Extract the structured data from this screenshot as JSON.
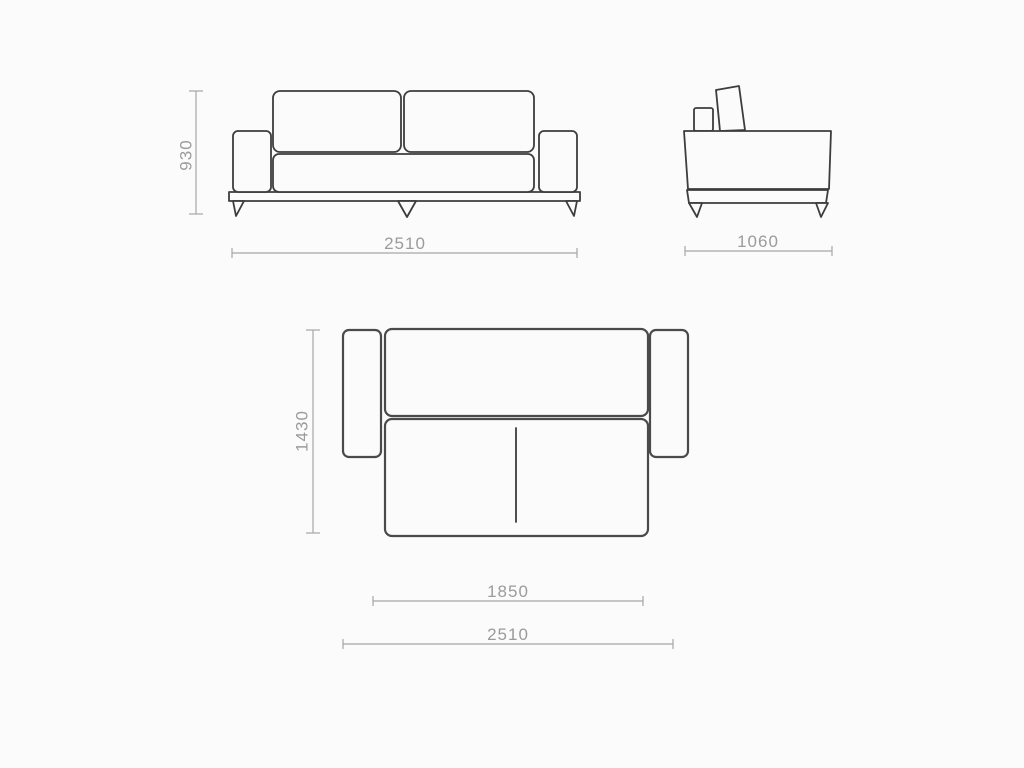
{
  "document": {
    "type": "furniture-dimension-drawing",
    "subject": "sofa-bed three-view technical drawing"
  },
  "colors": {
    "background": "#fbfbfb",
    "object_outline": "#3d3d3d",
    "dimension_line": "#a6a6a6",
    "dimension_text": "#9b9b9b"
  },
  "views": {
    "front": {
      "height": "930",
      "width": "2510"
    },
    "side": {
      "depth": "1060"
    },
    "top": {
      "depth": "1430",
      "inner_width": "1850",
      "width": "2510"
    }
  }
}
